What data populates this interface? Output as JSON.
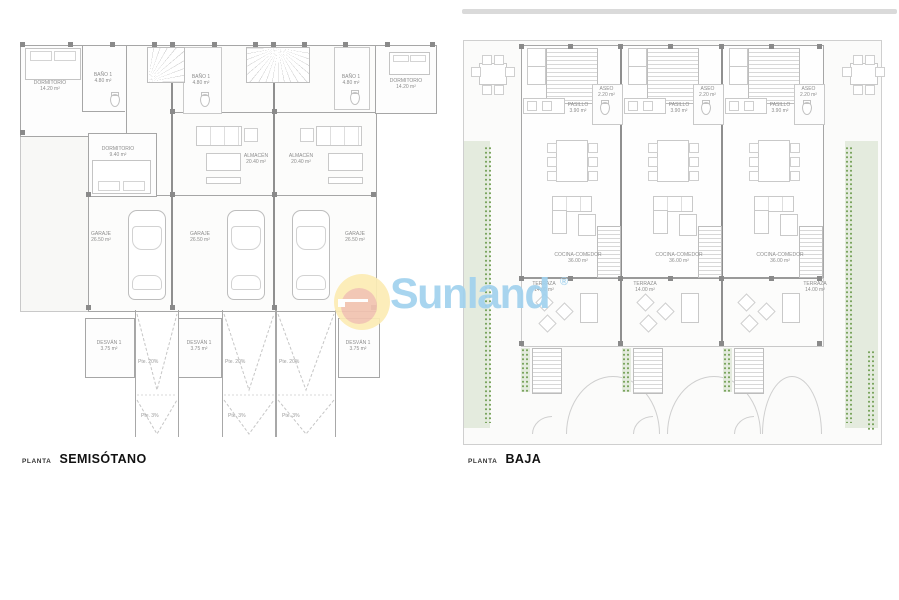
{
  "sheet": {
    "background": "#ffffff"
  },
  "watermark": {
    "brand": "Sunland",
    "registered": "®",
    "colors": {
      "text": "#a2d2ee",
      "circle_outer": "#fcecb5",
      "circle_inner": "#f2c3b0"
    }
  },
  "plans": {
    "semisotano": {
      "title_prefix": "PLANTA",
      "title": "SEMISÓTANO",
      "rooms": {
        "dormitorio_grande": {
          "name": "DORMITORIO",
          "area": "14.20 m²"
        },
        "bano": {
          "name": "BAÑO 1",
          "area": "4.80 m²"
        },
        "dormitorio_pequeno": {
          "name": "DORMITORIO",
          "area": "9.40 m²"
        },
        "almacen": {
          "name": "ALMACÉN",
          "area": "20.40 m²"
        },
        "garaje": {
          "name": "GARAJE",
          "area": "26.50 m²"
        },
        "desvan": {
          "name": "DESVÁN 1",
          "area": "3.75 m²"
        }
      },
      "slopes": {
        "ramp": "Pte. 20%",
        "apron": "Pte. 3%"
      }
    },
    "baja": {
      "title_prefix": "PLANTA",
      "title": "BAJA",
      "rooms": {
        "aseo": {
          "name": "ASEO",
          "area": "2.20 m²"
        },
        "pasillo": {
          "name": "PASILLO",
          "area": "3.90 m²"
        },
        "cocina_comedor": {
          "name": "COCINA-COMEDOR",
          "area": "36.00 m²"
        },
        "terraza": {
          "name": "TERRAZA",
          "area": "14.00 m²"
        }
      }
    }
  },
  "palette": {
    "garden_green": "#e4ebde",
    "plant_green": "#7ba55f",
    "wall_gray": "#a6a6a6"
  }
}
